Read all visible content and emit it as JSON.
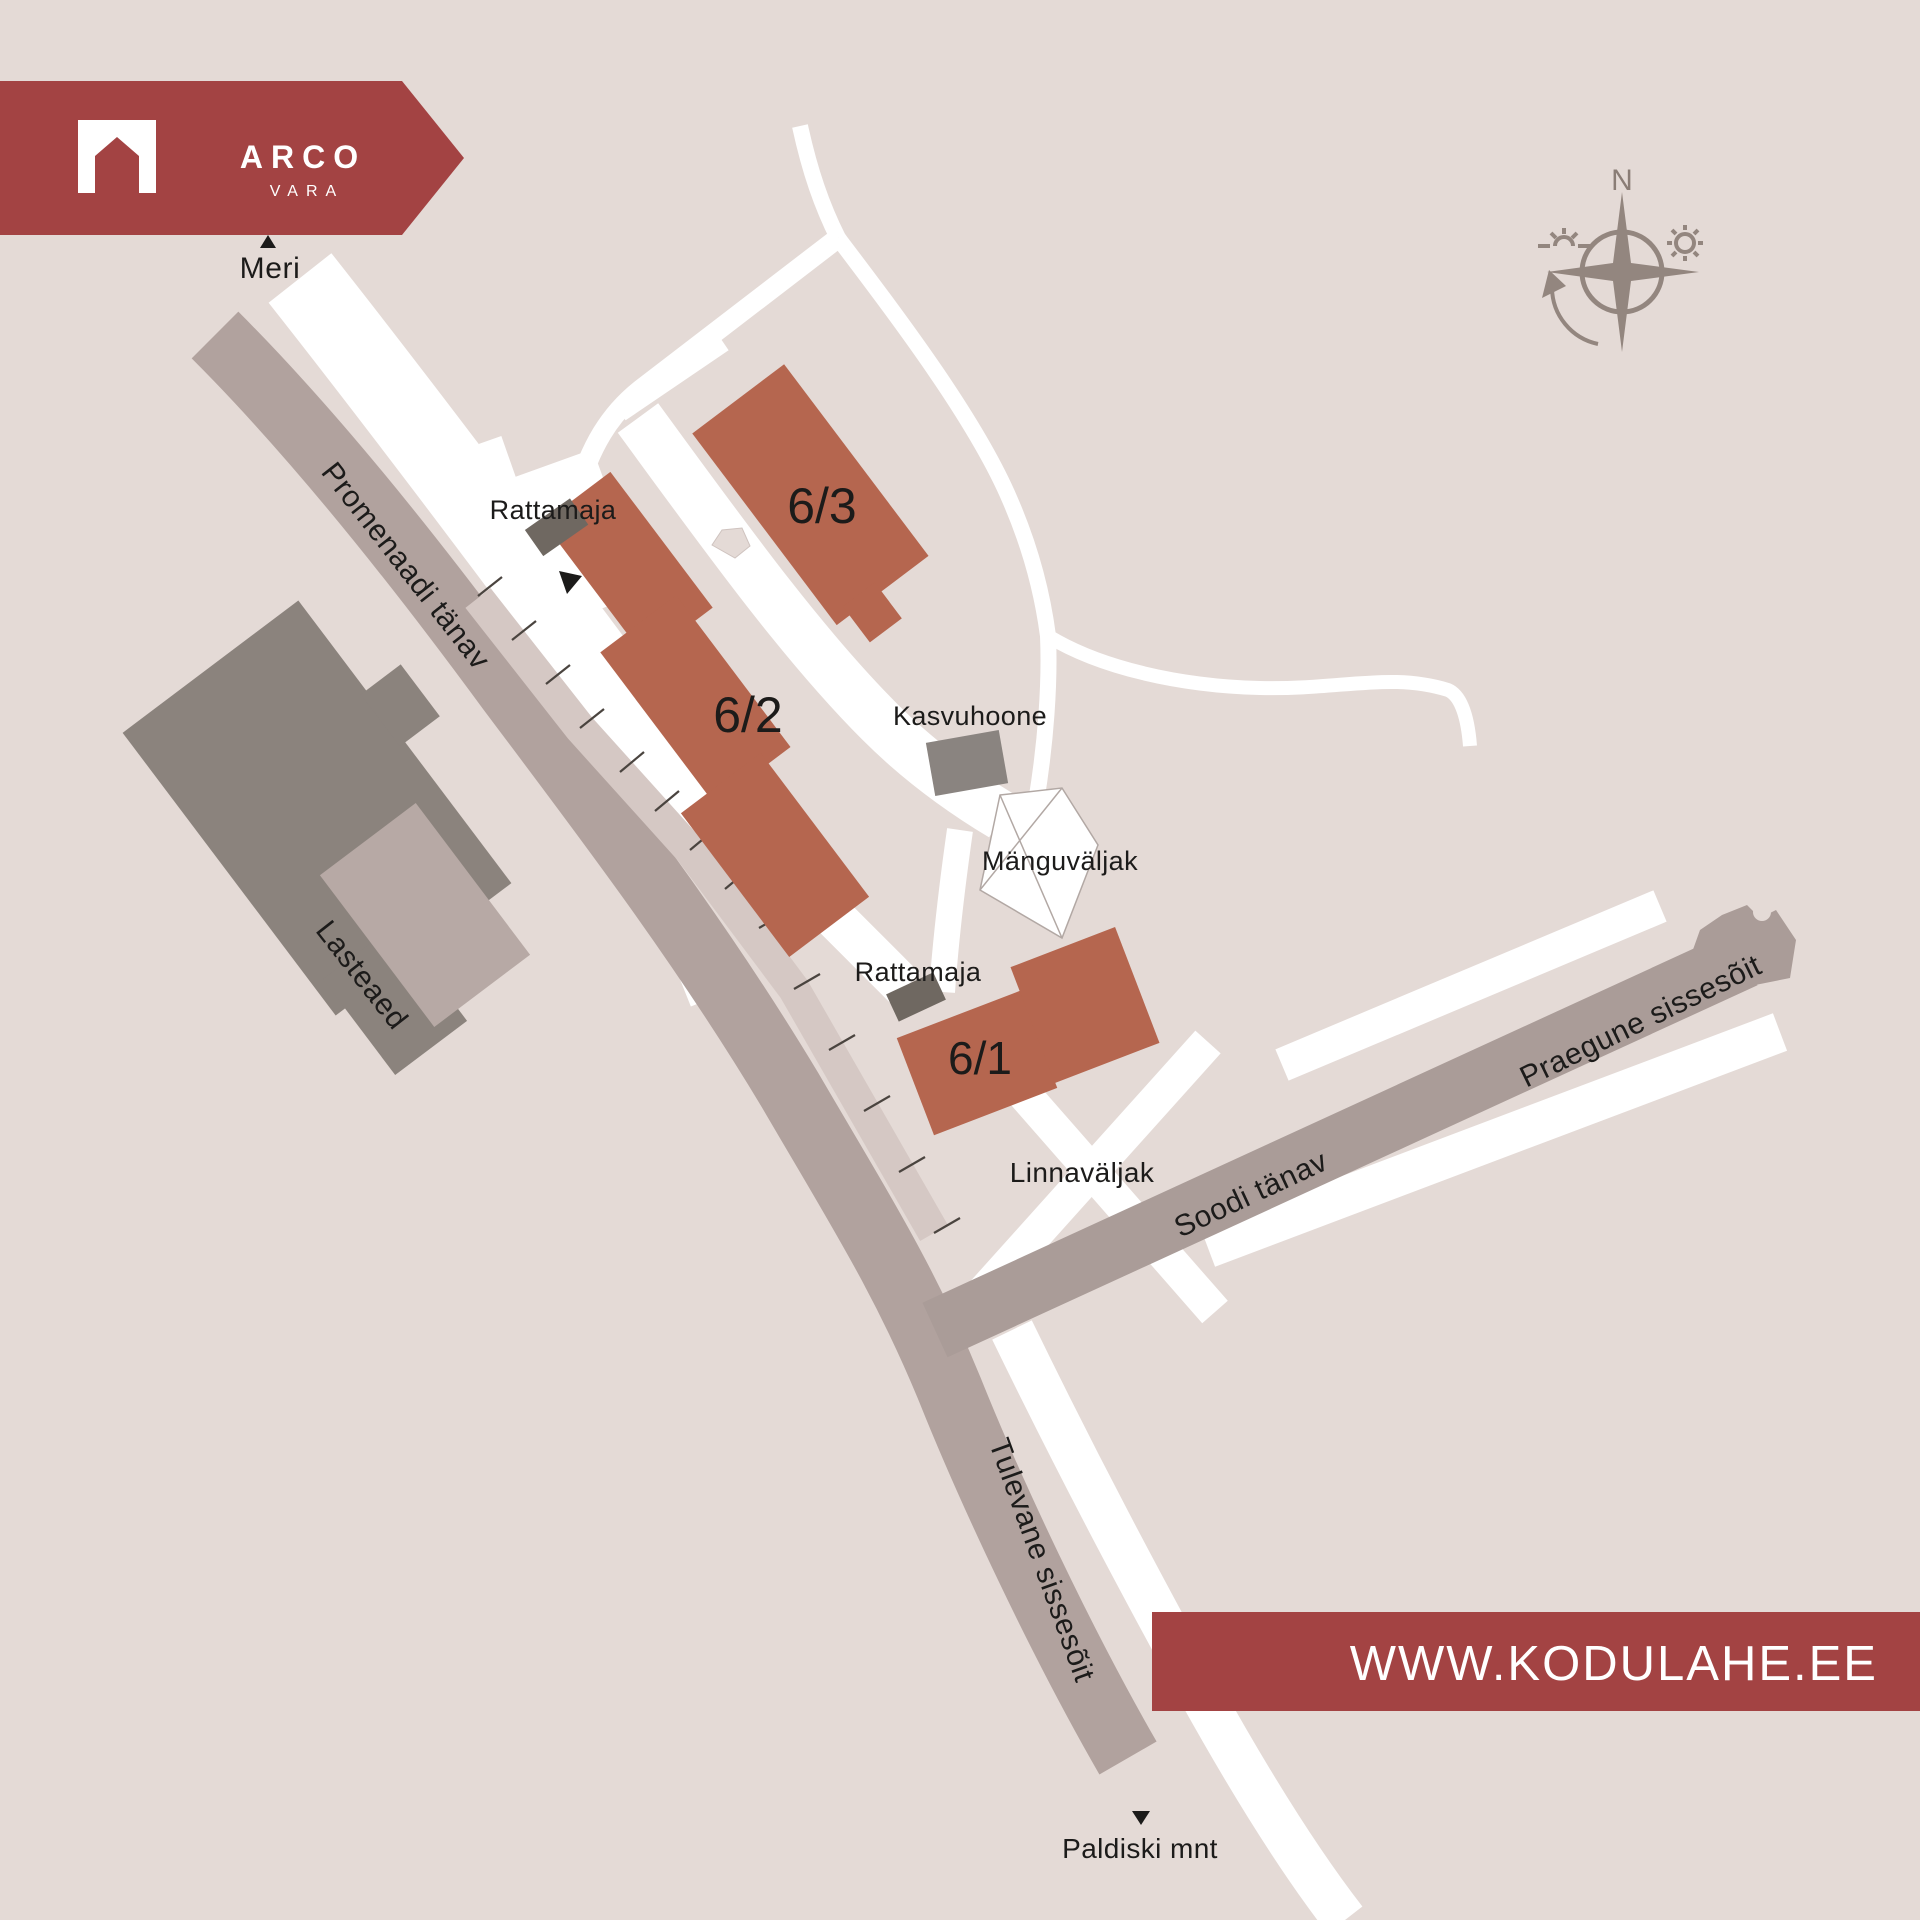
{
  "title": "Kodulahe site plan map",
  "colors": {
    "background": "#e4dad6",
    "accent_red": "#a34343",
    "building_terracotta": "#b5664f",
    "building_dark_gray": "#8b837d",
    "building_small_gray": "#6f6861",
    "building_annex": "#b7a9a5",
    "street_gray": "#b1a29e",
    "street_gray_dark": "#aa9c98",
    "road_white": "#ffffff",
    "compass_gray": "#93867f",
    "label_black": "#1c1b1a"
  },
  "logo": {
    "brand": "ARCO",
    "sub": "VARA",
    "icon": "arch-house"
  },
  "compass": {
    "north_label": "N"
  },
  "labels": {
    "meri": "Meri",
    "promenaadi": "Promenaadi tänav",
    "rattamaja_top": "Rattamaja",
    "b63": "6/3",
    "b62": "6/2",
    "kasvuhoone": "Kasvuhoone",
    "manguvaljak": "Mänguväljak",
    "rattamaja_bottom": "Rattamaja",
    "b61": "6/1",
    "linnavaljak": "Linnaväljak",
    "soodi": "Soodi tänav",
    "praegune": "Praegune sissesõit",
    "tulevane": "Tulevane sissesõit",
    "paldiski": "Paldiski mnt",
    "lasteaed": "Lasteaed"
  },
  "footer": {
    "website": "WWW.KODULAHE.EE"
  }
}
